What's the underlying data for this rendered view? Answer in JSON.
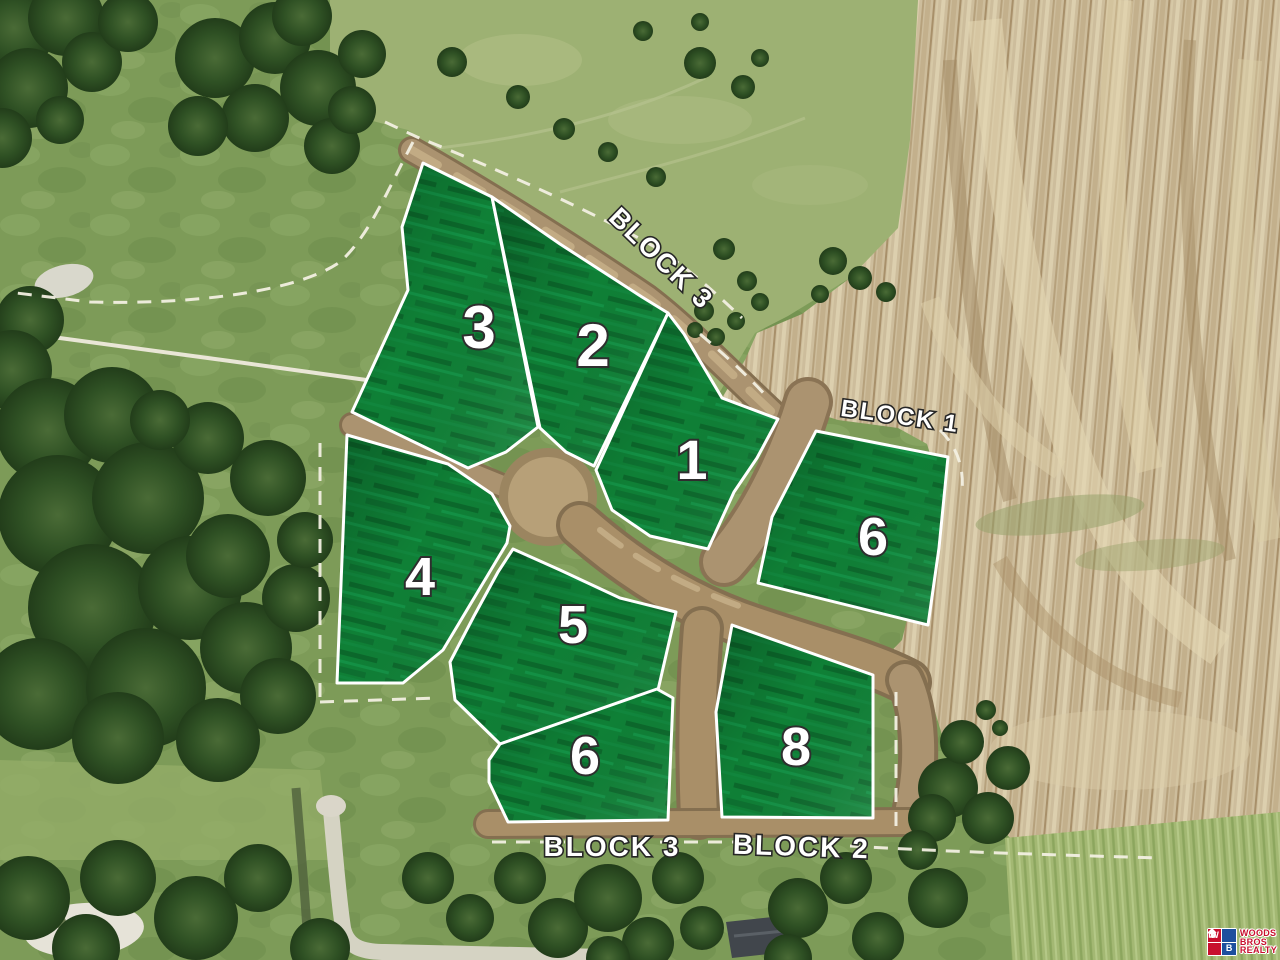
{
  "map": {
    "description": "aerial-development-plat",
    "lots": [
      {
        "id": "lot-3-block3",
        "number": "3"
      },
      {
        "id": "lot-2-block3",
        "number": "2"
      },
      {
        "id": "lot-1-block3",
        "number": "1"
      },
      {
        "id": "lot-6-block1",
        "number": "6"
      },
      {
        "id": "lot-4-block3",
        "number": "4"
      },
      {
        "id": "lot-5-block3",
        "number": "5"
      },
      {
        "id": "lot-6-block3",
        "number": "6"
      },
      {
        "id": "lot-8-block2",
        "number": "8"
      }
    ],
    "block_labels": {
      "top": "BLOCK 3",
      "right": "BLOCK 1",
      "bottom_left": "BLOCK 3",
      "bottom_right": "BLOCK 2"
    },
    "colors": {
      "lot_fill_green": "#0f8036",
      "lot_border": "#ffffff",
      "label_text": "#ffffff",
      "label_outline": "#2e2e2e",
      "dirt_tan": "#cdbd9c",
      "grass_green": "#7d9b58",
      "road_brown": "#a58c66",
      "dashed_line": "#f2efe2"
    }
  },
  "branding": {
    "logo": {
      "letter_w": "W",
      "letter_b": "B",
      "word1": "WOODS",
      "word2": "BROS",
      "word3": "REALTY",
      "red": "#c8102e",
      "blue": "#1d4f9e"
    }
  }
}
